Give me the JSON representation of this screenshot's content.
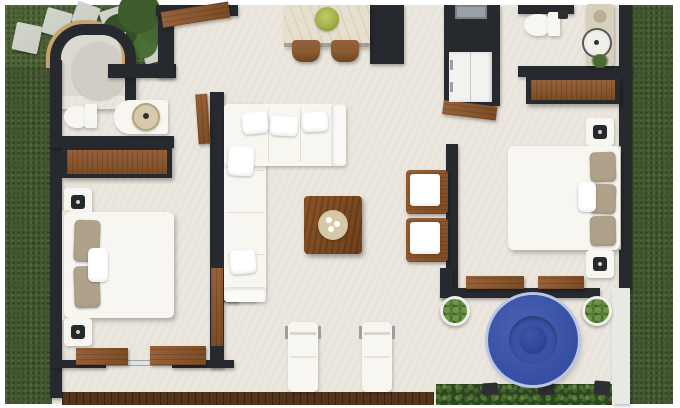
{
  "palette": {
    "margin": "#ffffff",
    "floor": "#ebe7de",
    "floor_entry": "#dcd9d0",
    "wall": "#26292e",
    "grass": "#44582f",
    "grass_light": "#4e6436",
    "wood": "#8a5a31",
    "deck": "#53351d",
    "white_furniture": "#f7f6f1",
    "tan_pillow": "#b0a28a",
    "stone": "#c8ccc2",
    "rug": "#d0cdc4",
    "basin": "#d8c9ac",
    "stone_counter": "#d8d0bc",
    "marble": "#e7dfcd",
    "bowl_green": "#a3b04a",
    "sink": "#9aa0a4",
    "fridge": "#f2f2ef",
    "pool_rim": "#b9c6e4",
    "pool": "#3a53a6",
    "pool_mid": "#31479b",
    "pool_core": "#2c4090",
    "hedge": "#2f4520",
    "leaf": "#4d7030",
    "glass": "#dfe3e4",
    "white_wall": "#e9e9e6",
    "wood_trim": "#c9a36b"
  },
  "scene": {
    "type": "top-down 3D floor plan render",
    "areas": [
      "garden",
      "entry-patio",
      "bathroom-1",
      "bedroom-1",
      "living-room",
      "kitchen",
      "hallway",
      "bathroom-2",
      "bedroom-2",
      "sun-deck",
      "pool-patio"
    ],
    "inventory": [
      "stepping-stones x6",
      "shrubs",
      "curved-entry-wall",
      "round-rug",
      "toilet x2",
      "vanity-basin x2",
      "wardrobe x2",
      "double-bed x2",
      "nightstand-with-lamp x4",
      "wall-desk x2",
      "l-shaped-sofa",
      "coffee-table-with-tray",
      "kitchen-island-with-bowl",
      "bar-stool x2",
      "pantry-unit",
      "sink-fridge-column",
      "open-door x3",
      "armchair x2",
      "wall-bench x2",
      "sun-lounger x2",
      "round-plunge-pool",
      "potted-plant x2",
      "hedge-with-planters",
      "wood-deck"
    ]
  }
}
